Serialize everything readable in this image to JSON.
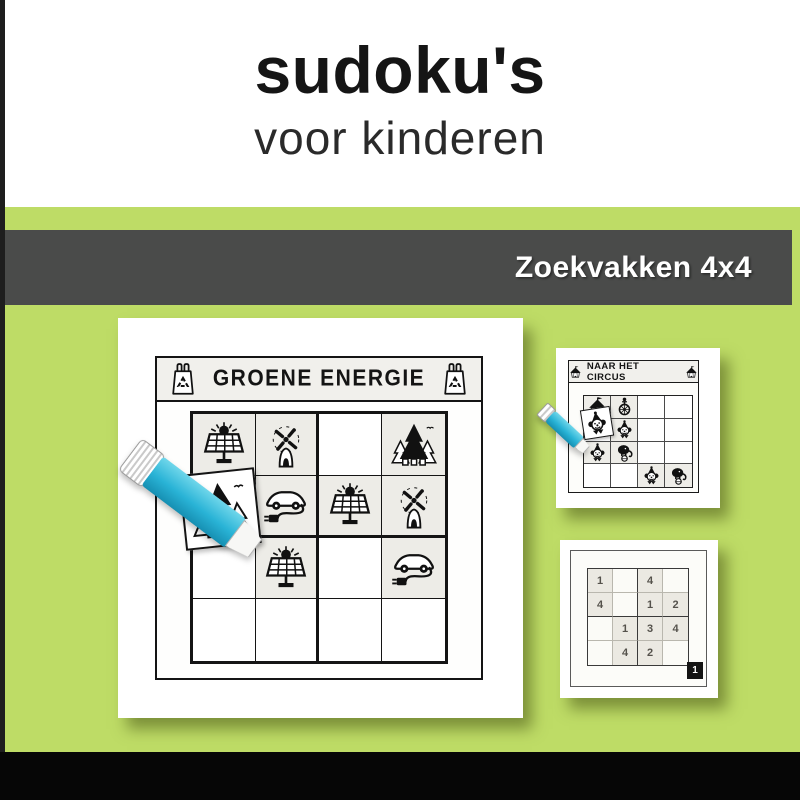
{
  "header": {
    "title": "sudoku's",
    "subtitle": "voor kinderen"
  },
  "banner": {
    "label": "Zoekvakken 4x4"
  },
  "colors": {
    "background_green": "#bedc66",
    "banner_gray": "#4a4b4a",
    "footer_black": "#060606",
    "glue_stick_cyan": "#29b3d6",
    "card_white": "#ffffff",
    "puzzle_ink": "#141414",
    "filled_cell_gray": "#edece7"
  },
  "main_puzzle": {
    "title": "GROENE ENERGIE",
    "header_icons": [
      "recycle-bag-icon",
      "recycle-bag-icon"
    ],
    "grid": [
      [
        "solar-panel",
        "windmill",
        null,
        "trees"
      ],
      [
        null,
        "e-car",
        "solar-panel",
        "windmill"
      ],
      [
        null,
        "solar-panel",
        null,
        "e-car"
      ],
      [
        null,
        null,
        null,
        null
      ]
    ],
    "tile_icon": "trees",
    "tool": "glue-stick"
  },
  "circus_puzzle": {
    "title": "NAAR HET CIRCUS",
    "header_icons": [
      "circus-tent-icon",
      "circus-tent-icon"
    ],
    "grid": [
      [
        "tent",
        "unicycle",
        null,
        null
      ],
      [
        null,
        "clown",
        null,
        null
      ],
      [
        "clown",
        "elephant",
        null,
        null
      ],
      [
        null,
        null,
        "clown",
        "elephant"
      ]
    ],
    "tile_icon": "clown",
    "tool": "glue-stick"
  },
  "number_puzzle": {
    "grid": [
      [
        "1",
        "",
        "4",
        ""
      ],
      [
        "4",
        "",
        "1",
        "2"
      ],
      [
        "",
        "1",
        "3",
        "4"
      ],
      [
        "",
        "4",
        "2",
        ""
      ]
    ],
    "page_number": "1"
  }
}
